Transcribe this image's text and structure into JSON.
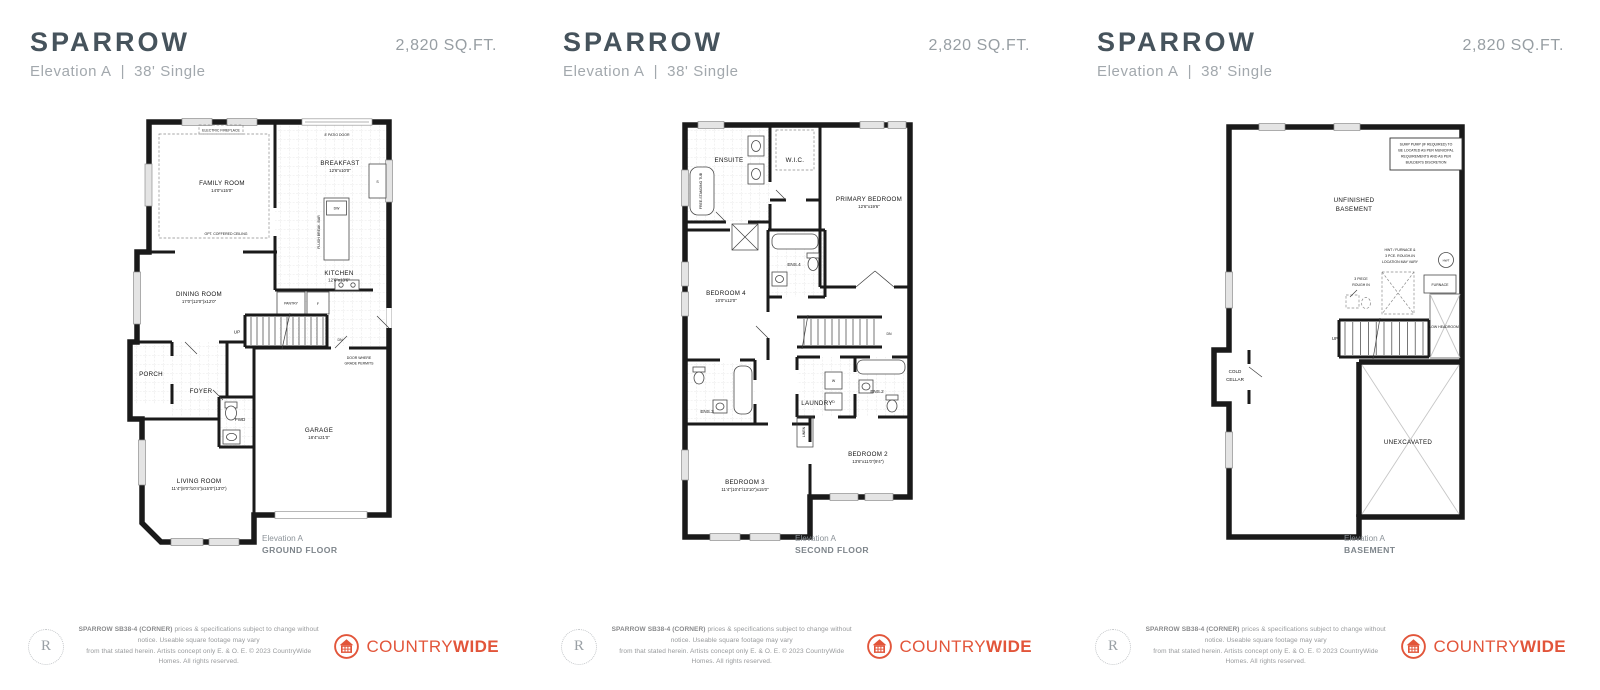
{
  "brand": {
    "monogram": "R",
    "logo_regular": "COUNTRY",
    "logo_bold": "WIDE",
    "accent": "#e2553a"
  },
  "footer": {
    "bold": "SPARROW SB38-4 (CORNER)",
    "rest1": " prices & specifications subject to change without notice. Useable square footage may vary",
    "line2": "from that stated herein. Artists concept only E. & O. E. © 2023 CountryWide Homes. All rights reserved."
  },
  "panels": [
    {
      "header": {
        "title": "SPARROW",
        "elevation": "Elevation A",
        "divider": "|",
        "lot": "38' Single",
        "sqft": "2,820 SQ.FT."
      },
      "caption": {
        "line1": "Elevation A",
        "line2": "GROUND FLOOR"
      },
      "labels": {
        "patio_door": "8' PATIO DOOR",
        "electric_fireplace": "ELECTRIC FIREPLACE",
        "family_room": "FAMILY ROOM",
        "family_room_dim": "14'0\"x15'0\"",
        "coffered_ceiling": "OPT. COFFERED CEILING",
        "breakfast": "BREAKFAST",
        "breakfast_dim": "12'6\"x10'0\"",
        "dw": "DW",
        "flush_bar": "FLUSH BREAK. BAR",
        "sink": "S",
        "kitchen": "KITCHEN",
        "kitchen_dim": "12'6\"x13'6\"",
        "pantry": "PANTRY",
        "fridge": "F",
        "dining_room": "DINING ROOM",
        "dining_room_dim": "17'0\"(12'0\")x12'0\"",
        "up": "UP",
        "dn": "DN",
        "grade_door_1": "DOOR WHERE",
        "grade_door_2": "GRADE PERMITS",
        "porch": "PORCH",
        "foyer": "FOYER",
        "pwd": "PWD",
        "garage": "GARAGE",
        "garage_dim": "18'4\"x21'0\"",
        "living_room": "LIVING ROOM",
        "living_room_dim": "11'4\"(8'0\"/10'4\")x15'0\"(13'0\")"
      }
    },
    {
      "header": {
        "title": "SPARROW",
        "elevation": "Elevation A",
        "divider": "|",
        "lot": "38' Single",
        "sqft": "2,820 SQ.FT."
      },
      "caption": {
        "line1": "Elevation A",
        "line2": "SECOND FLOOR"
      },
      "labels": {
        "ensuite": "ENSUITE",
        "free_standing_tub": "FREE-STANDING TUB",
        "wic": "W.I.C.",
        "primary_bedroom": "PRIMARY BEDROOM",
        "primary_bedroom_dim": "12'6\"x19'6\"",
        "ens4": "ENS.4",
        "bedroom4": "BEDROOM 4",
        "bedroom4_dim": "10'0\"x12'0\"",
        "dn": "DN",
        "laundry": "LAUNDRY",
        "washer": "W",
        "dryer": "D",
        "ens2": "ENS.2",
        "ens3": "ENS.3",
        "linen": "LINEN",
        "bedroom2": "BEDROOM 2",
        "bedroom2_dim": "13'6\"x11'0\"(9'4\")",
        "bedroom3": "BEDROOM 3",
        "bedroom3_dim": "11'4\"(10'4\"/13'10\")x15'0\""
      }
    },
    {
      "header": {
        "title": "SPARROW",
        "elevation": "Elevation A",
        "divider": "|",
        "lot": "38' Single",
        "sqft": "2,820 SQ.FT."
      },
      "caption": {
        "line1": "Elevation A",
        "line2": "BASEMENT"
      },
      "labels": {
        "sump_1": "SUMP PUMP (IF REQUIRED) TO",
        "sump_2": "BE LOCATED AS PER MUNICIPAL",
        "sump_3": "REQUIREMENTS AND AS PER",
        "sump_4": "BUILDER'S DISCRETION",
        "unfinished_1": "UNFINISHED",
        "unfinished_2": "BASEMENT",
        "hwt_note_1": "HWT / FURNACE &",
        "hwt_note_2": "3 PCE. ROUGH-IN",
        "hwt_note_3": "LOCATION MAY VARY",
        "hwt": "HWT",
        "furnace": "FURNACE",
        "rough_in_1": "3 PIECE",
        "rough_in_2": "ROUGH IN",
        "low_headroom": "LOW HEADROOM",
        "up": "UP",
        "cold_cellar_1": "COLD",
        "cold_cellar_2": "CELLAR",
        "unexcavated": "UNEXCAVATED"
      }
    }
  ]
}
